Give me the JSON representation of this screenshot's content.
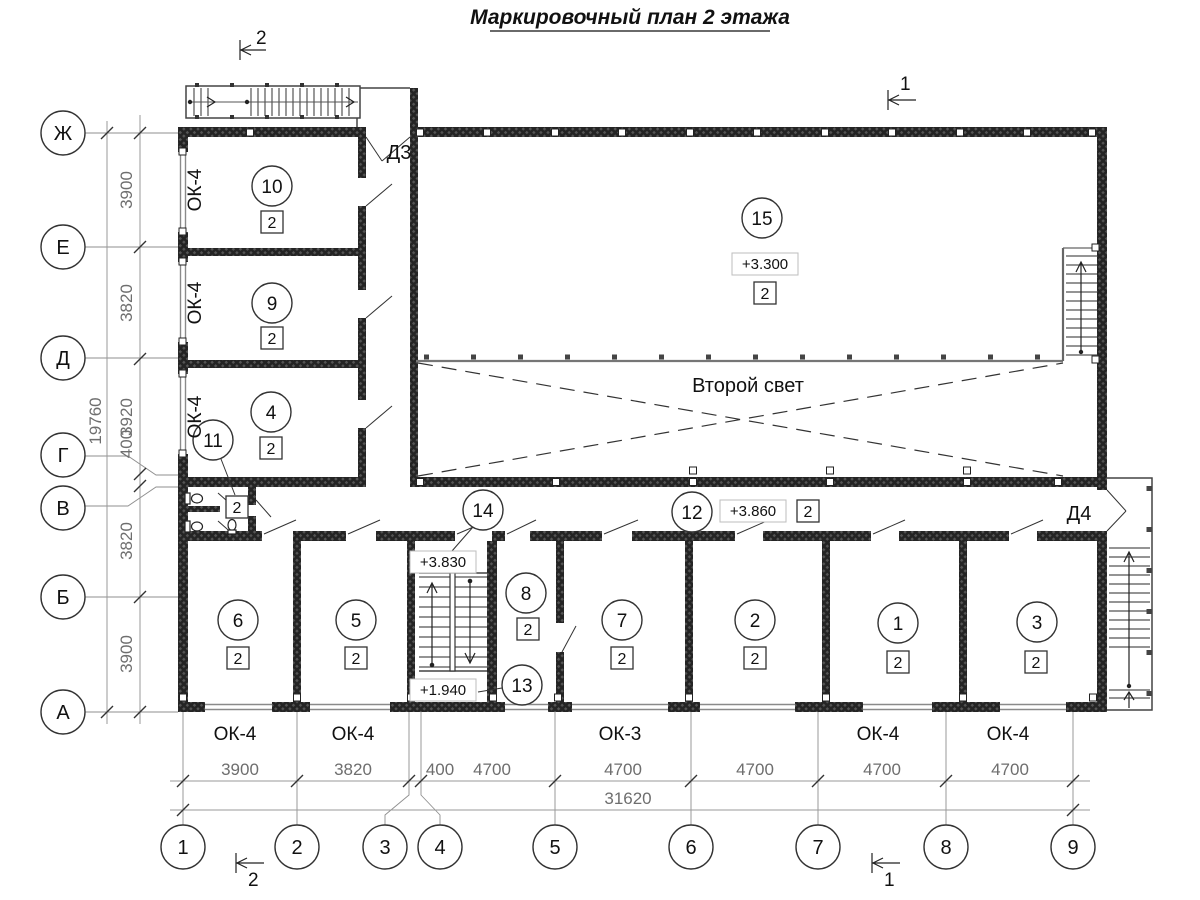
{
  "title": "Маркировочный план 2 этажа",
  "second_light": "Второй свет",
  "axis_letters": [
    "Ж",
    "Е",
    "Д",
    "Г",
    "В",
    "Б",
    "А"
  ],
  "axis_numbers": [
    "1",
    "2",
    "3",
    "4",
    "5",
    "6",
    "7",
    "8",
    "9"
  ],
  "dim_left": [
    "3900",
    "3820",
    "3920",
    "400",
    "3820",
    "3900"
  ],
  "dim_left_total": "19760",
  "dim_bottom": [
    "3900",
    "3820",
    "400",
    "4700",
    "4700",
    "4700",
    "4700",
    "4700"
  ],
  "dim_bottom_total": "31620",
  "window_labels_left": [
    "ОК-4",
    "ОК-4",
    "ОК-4"
  ],
  "window_labels_bottom": [
    "ОК-4",
    "ОК-4",
    "ОК-3",
    "ОК-4",
    "ОК-4"
  ],
  "door_labels": {
    "d3": "Д3",
    "d4": "Д4"
  },
  "section_marks": {
    "top_left": "2",
    "bottom_left": "2",
    "top_right": "1",
    "bottom_right": "1"
  },
  "levels": {
    "hall": "+3.300",
    "stair_upper": "+3.830",
    "corridor": "+3.860",
    "stair_lower": "+1.940"
  },
  "rooms": {
    "r10": {
      "number": "10",
      "type": "2"
    },
    "r9": {
      "number": "9",
      "type": "2"
    },
    "r4": {
      "number": "4",
      "type": "2"
    },
    "r11": {
      "number": "11",
      "type": "2"
    },
    "r15": {
      "number": "15",
      "type": "2"
    },
    "r12": {
      "number": "12",
      "type": "2"
    },
    "r14": {
      "number": "14"
    },
    "r13": {
      "number": "13"
    },
    "r8": {
      "number": "8",
      "type": "2"
    },
    "r6": {
      "number": "6",
      "type": "2"
    },
    "r5": {
      "number": "5",
      "type": "2"
    },
    "r7": {
      "number": "7",
      "type": "2"
    },
    "r2": {
      "number": "2",
      "type": "2"
    },
    "r1": {
      "number": "1",
      "type": "2"
    },
    "r3": {
      "number": "3",
      "type": "2"
    }
  },
  "colors": {
    "wall": "#242424",
    "dim_text": "#6e6e6e",
    "gray_line": "#8a8a8a"
  }
}
